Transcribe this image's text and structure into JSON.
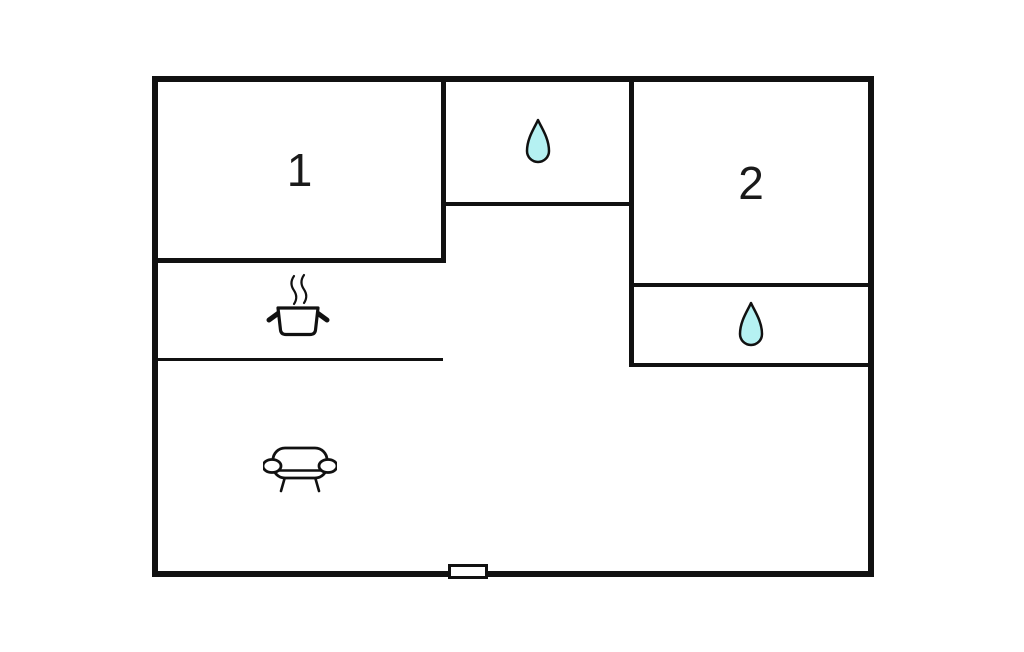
{
  "floorplan": {
    "background_color": "#ffffff",
    "wall_color": "#111111",
    "rooms": [
      {
        "id": "room-1",
        "label": "1"
      },
      {
        "id": "room-2",
        "label": "2"
      }
    ],
    "bathrooms": [
      {
        "icon": "water-drop-icon",
        "position": "top-middle"
      },
      {
        "icon": "water-drop-icon",
        "position": "below-room-2"
      }
    ],
    "kitchen": {
      "icon": "stove-icon"
    },
    "living_room": {
      "icon": "sofa-icon"
    },
    "entrance": {
      "icon": "door-marker",
      "position": "bottom-wall"
    },
    "colors": {
      "water_drop_fill": "#b5f1f2",
      "icon_stroke": "#111111"
    }
  }
}
